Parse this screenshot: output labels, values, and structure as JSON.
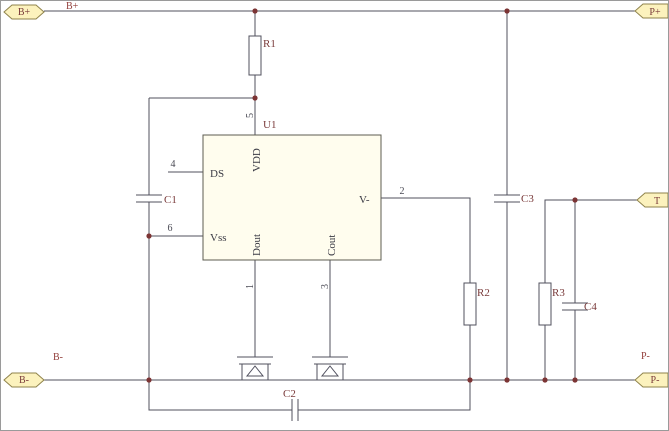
{
  "ports": {
    "b_plus": "B+",
    "p_plus": "P+",
    "t": "T",
    "b_minus": "B-",
    "p_minus": "P-"
  },
  "net_labels": {
    "b_plus": "B+",
    "b_minus": "B-",
    "p_minus": "P-"
  },
  "components": {
    "r1": "R1",
    "r2": "R2",
    "r3": "R3",
    "c1": "C1",
    "c2": "C2",
    "c3": "C3",
    "c4": "C4",
    "u1": "U1"
  },
  "ic": {
    "designator": "U1",
    "pin_names": {
      "vdd": "VDD",
      "ds": "DS",
      "vss": "Vss",
      "dout": "Dout",
      "cout": "Cout",
      "v_minus": "V-"
    },
    "pin_numbers": {
      "p1": "1",
      "p2": "2",
      "p3": "3",
      "p4": "4",
      "p5": "5",
      "p6": "6"
    }
  },
  "colors": {
    "wire": "#50505e",
    "junction_dot": "#7c3434",
    "ic_fill": "#fffdee",
    "port_fill": "#fcf2bd",
    "port_border": "#8f834b",
    "label_text": "#7a3b3b",
    "net_label_text": "#93403c",
    "pin_text": "#3a3a44",
    "background": "#ffffff"
  }
}
